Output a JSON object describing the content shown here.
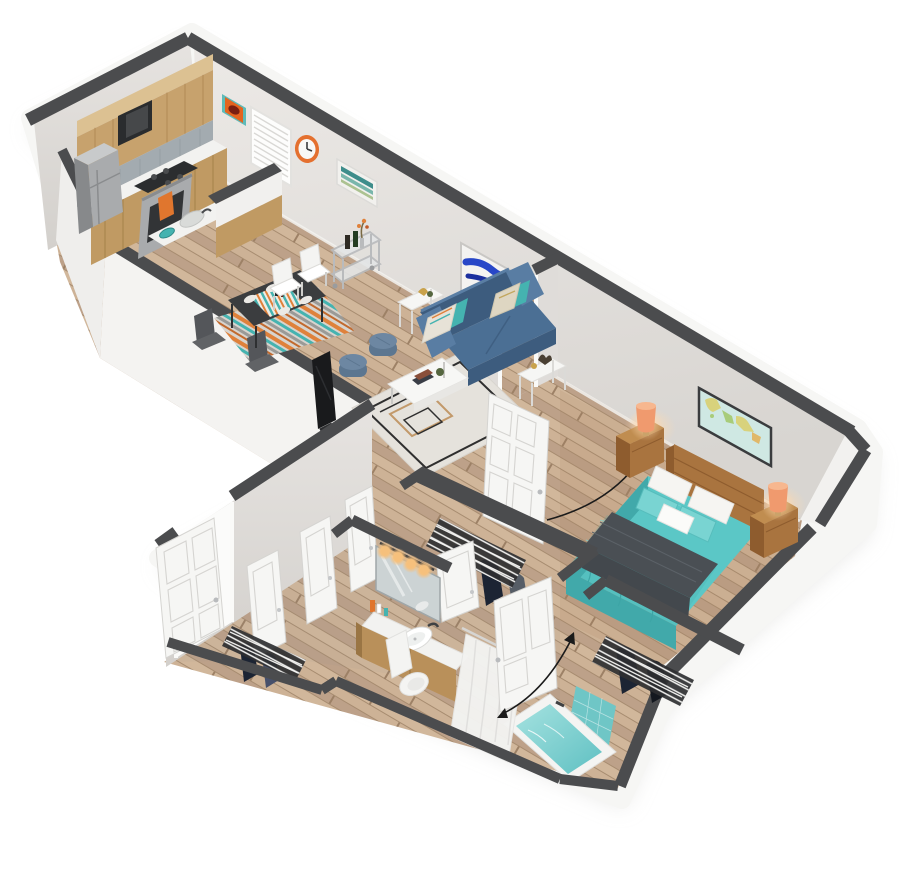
{
  "scene": {
    "title": "3D isometric one-bedroom apartment floor plan render",
    "style": "dollhouse cutaway render, no text labels",
    "rooms": [
      {
        "name": "kitchen",
        "features": [
          "upper wood cabinets with soffit",
          "built-in microwave",
          "stainless gas range with orange towel",
          "stainless refrigerator",
          "gray stone backsplash",
          "white countertop",
          "peninsula half-wall with sink and teal bowl"
        ]
      },
      {
        "name": "dining-area",
        "features": [
          "dark rectangular dining table",
          "striped multicolor table runner",
          "four white place settings",
          "two white chairs",
          "two dark chairs",
          "striped orange-teal area rug",
          "metal bar cart with bottles and flowers"
        ]
      },
      {
        "name": "living-room",
        "features": [
          "blue loveseat with patterned pillows",
          "white coffee table with books and plant",
          "two white metal end tables with decor",
          "geometric-pattern cream rug",
          "two blue-gray round poufs",
          "flat-screen TV along the lower wall",
          "blue abstract painting"
        ]
      },
      {
        "name": "bedroom",
        "features": [
          "queen bed with teal bedding",
          "charcoal throw blanket",
          "wood headboard",
          "two wood nightstands",
          "two orange table lamps",
          "world map wall art",
          "wire-shelf closet with hanging clothes",
          "angled corner wall"
        ]
      },
      {
        "name": "bathroom",
        "features": [
          "wood vanity with white counter and round sink",
          "mirror with four edison vanity bulbs",
          "toiletries",
          "white toilet",
          "soaking tub with teal water",
          "teal tile surround",
          "white shower curtain on angled rod"
        ]
      },
      {
        "name": "entry-hallway",
        "features": [
          "open white six-panel entry door",
          "three white closet doors",
          "wire-shelf linen closet",
          "walk-in closet with wire shelf and clothes"
        ]
      }
    ],
    "wall_items": [
      "orange abstract art in teal frame",
      "window with white blinds",
      "orange wall clock",
      "teal streak art",
      "blue abstract painting",
      "world map"
    ],
    "annotations": [
      "bathroom door swing arc with arrows",
      "bedroom door swing arc with arrow"
    ]
  },
  "palette": {
    "background": "#ffffff",
    "cap": "#4b4c4e",
    "wallLight": "#ebe9e6",
    "wallMid": "#dfdcd9",
    "wallDark": "#d2cfcc",
    "slab": "#f6f6f4",
    "floorBase": "#c9ae92",
    "plankDark": "#b89c80",
    "plankLight": "#d3b99d",
    "plankLine": "#a78c70",
    "cabinet": "#c7a26d",
    "cabinetDark": "#a87f4c",
    "soffit": "#dcc192",
    "backsplash": "#a3abb0",
    "counter": "#f2f2f0",
    "steel": "#a9abad",
    "steelDark": "#87898b",
    "applianceDark": "#2a2c2e",
    "towel": "#e0762e",
    "sofa": "#4b6f94",
    "sofaDark": "#3d5c7e",
    "sofaLight": "#597da3",
    "teal": "#45b3b0",
    "rugBase": "#e5e2dc",
    "rugLine": "#2f2f2f",
    "rugTan": "#c2996a",
    "tableDark": "#3b3d3f",
    "chairWhite": "#f4f4f2",
    "chairDark": "#54565a",
    "runnerOrange": "#df813b",
    "cartMetal": "#c3c5c7",
    "bedTeal": "#5bc7c6",
    "bedTealDark": "#41a9aa",
    "bedTealLight": "#79d4d2",
    "throw": "#4a4f54",
    "pillow": "#f6f5f2",
    "wood": "#a9743f",
    "woodLight": "#c08d50",
    "woodDark": "#8e5c2e",
    "lamp": "#f09a6e",
    "lampLight": "#f7b78f",
    "mapBg": "#cfe8e3",
    "mapLand": "#d8d27c",
    "artOrange": "#e4641f",
    "clockOrange": "#e4702f",
    "artBlue": "#2847c8",
    "artBlueDark": "#1b2f9e",
    "artTeal": "#3e8d8b",
    "mirror": "#ccd3d4",
    "bulb": "#f6c07c",
    "water": "#8ed8d8",
    "waterDeep": "#5fc0c2",
    "tile": "#6fc6c6",
    "curtain": "#f3f3f1",
    "fixture": "#f4f4f2",
    "wire": "#2e2f31",
    "wireLine": "#f4f4f2",
    "clothesA": "#2b3750",
    "clothesB": "#1c2433",
    "clothesC": "#47506b",
    "door": "#f6f6f4",
    "doorEdge": "#d5d4d1",
    "arc": "#1b1b1b",
    "shadow": "#d6d5d2"
  }
}
